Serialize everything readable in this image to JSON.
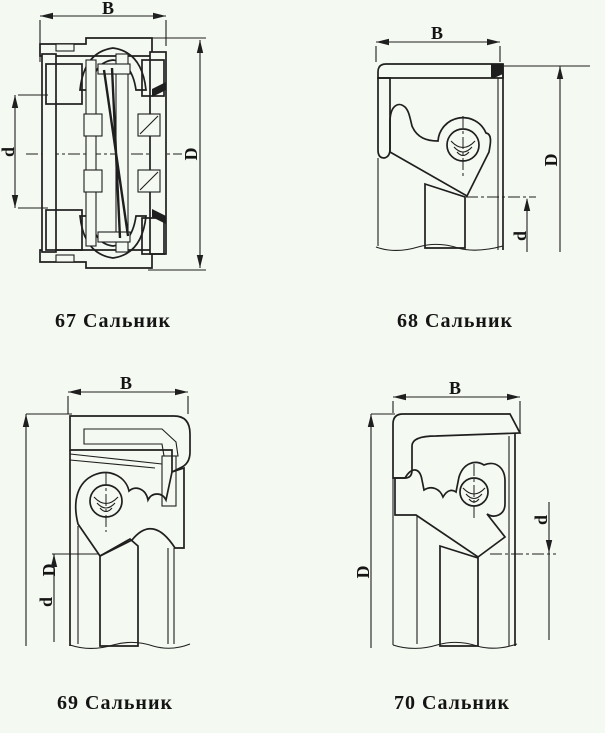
{
  "page": {
    "type": "scanned technical catalog sheet of oil seal cross-sections",
    "background_color": "#f4f9f1",
    "ink_color": "#1f1f1f"
  },
  "figures": [
    {
      "number": "67",
      "caption": "67 Сальник",
      "labels": {
        "width": "B",
        "outer": "D",
        "inner": "d"
      }
    },
    {
      "number": "68",
      "caption": "68 Сальник",
      "labels": {
        "width": "B",
        "outer": "D",
        "inner": "d"
      }
    },
    {
      "number": "69",
      "caption": "69 Сальник",
      "labels": {
        "width": "B",
        "outer": "D",
        "inner": "d"
      }
    },
    {
      "number": "70",
      "caption": "70 Сальник",
      "labels": {
        "width": "B",
        "outer": "D",
        "inner": "d"
      }
    }
  ]
}
